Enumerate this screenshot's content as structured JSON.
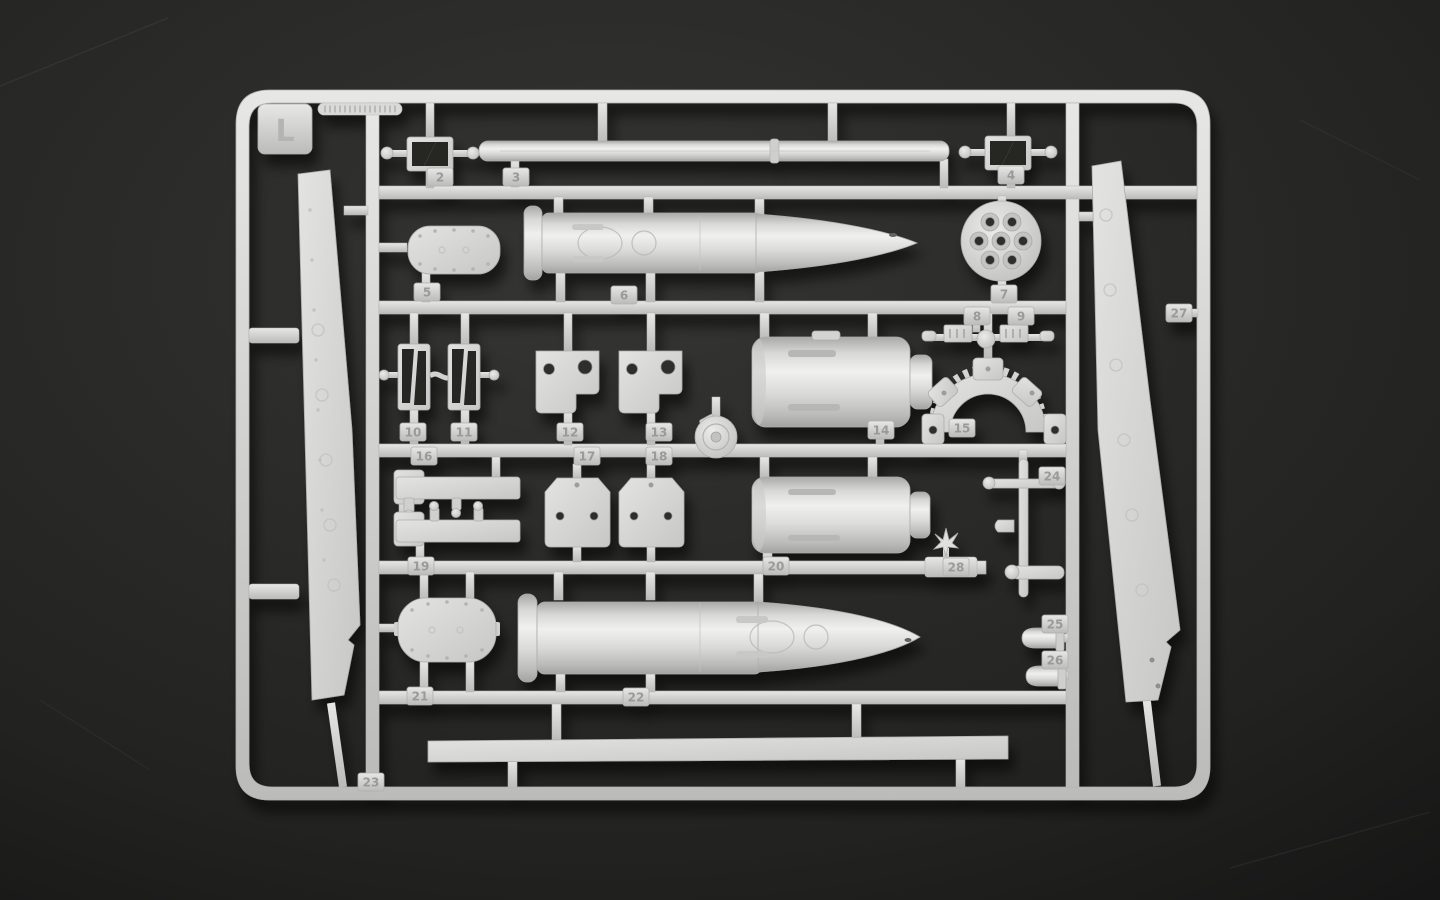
{
  "scene": {
    "description": "Photograph of a light-grey injection-molded plastic model-kit sprue (parts runner) on a dark charcoal background",
    "sprue_letter": "L",
    "plastic_color": "#d6d6d4",
    "background_color": "#242422",
    "contents": "Large artillery projectile shells, gun barrel rod, recoil cylinders, brackets, fender panels and small fittings, each with an embossed part-number tab"
  },
  "parts": [
    {
      "num": "2",
      "x": 440,
      "y": 177,
      "name": "turnbuckle-bracket"
    },
    {
      "num": "3",
      "x": 516,
      "y": 177,
      "name": "long-barrel-rod"
    },
    {
      "num": "4",
      "x": 1011,
      "y": 175,
      "name": "turnbuckle-bracket"
    },
    {
      "num": "5",
      "x": 427,
      "y": 292,
      "name": "riveted-oval-plate"
    },
    {
      "num": "6",
      "x": 624,
      "y": 295,
      "name": "large-projectile-shell"
    },
    {
      "num": "7",
      "x": 1004,
      "y": 294,
      "name": "perforated-round-plate"
    },
    {
      "num": "8",
      "x": 977,
      "y": 316,
      "name": "small-mount-fitting"
    },
    {
      "num": "9",
      "x": 1021,
      "y": 316,
      "name": "small-mount-fitting"
    },
    {
      "num": "10",
      "x": 413,
      "y": 432,
      "name": "turnbuckle-bracket-vertical"
    },
    {
      "num": "11",
      "x": 464,
      "y": 432,
      "name": "turnbuckle-bracket-vertical"
    },
    {
      "num": "12",
      "x": 570,
      "y": 432,
      "name": "box-bracket"
    },
    {
      "num": "13",
      "x": 659,
      "y": 432,
      "name": "box-bracket"
    },
    {
      "num": "14",
      "x": 881,
      "y": 430,
      "name": "recoil-cylinder"
    },
    {
      "num": "15",
      "x": 962,
      "y": 428,
      "name": "toothed-arc-quadrant"
    },
    {
      "num": "16",
      "x": 424,
      "y": 456,
      "name": "flat-linkage-bar"
    },
    {
      "num": "17",
      "x": 587,
      "y": 456,
      "name": "trapezoid-bracket"
    },
    {
      "num": "18",
      "x": 659,
      "y": 456,
      "name": "trapezoid-bracket"
    },
    {
      "num": "19",
      "x": 421,
      "y": 566,
      "name": "flat-linkage-bar"
    },
    {
      "num": "20",
      "x": 776,
      "y": 566,
      "name": "recoil-cylinder"
    },
    {
      "num": "21",
      "x": 420,
      "y": 696,
      "name": "riveted-oval-plate"
    },
    {
      "num": "22",
      "x": 636,
      "y": 697,
      "name": "large-projectile-shell"
    },
    {
      "num": "23",
      "x": 371,
      "y": 782,
      "name": "long-flat-strip"
    },
    {
      "num": "24",
      "x": 1052,
      "y": 476,
      "name": "rod-with-fittings"
    },
    {
      "num": "25",
      "x": 1055,
      "y": 624,
      "name": "small-cylinder-cap"
    },
    {
      "num": "26",
      "x": 1055,
      "y": 660,
      "name": "small-cylinder-cap"
    },
    {
      "num": "27",
      "x": 1179,
      "y": 313,
      "name": "fender-panel-right"
    },
    {
      "num": "28",
      "x": 956,
      "y": 567,
      "name": "small-sprocket-star"
    }
  ]
}
